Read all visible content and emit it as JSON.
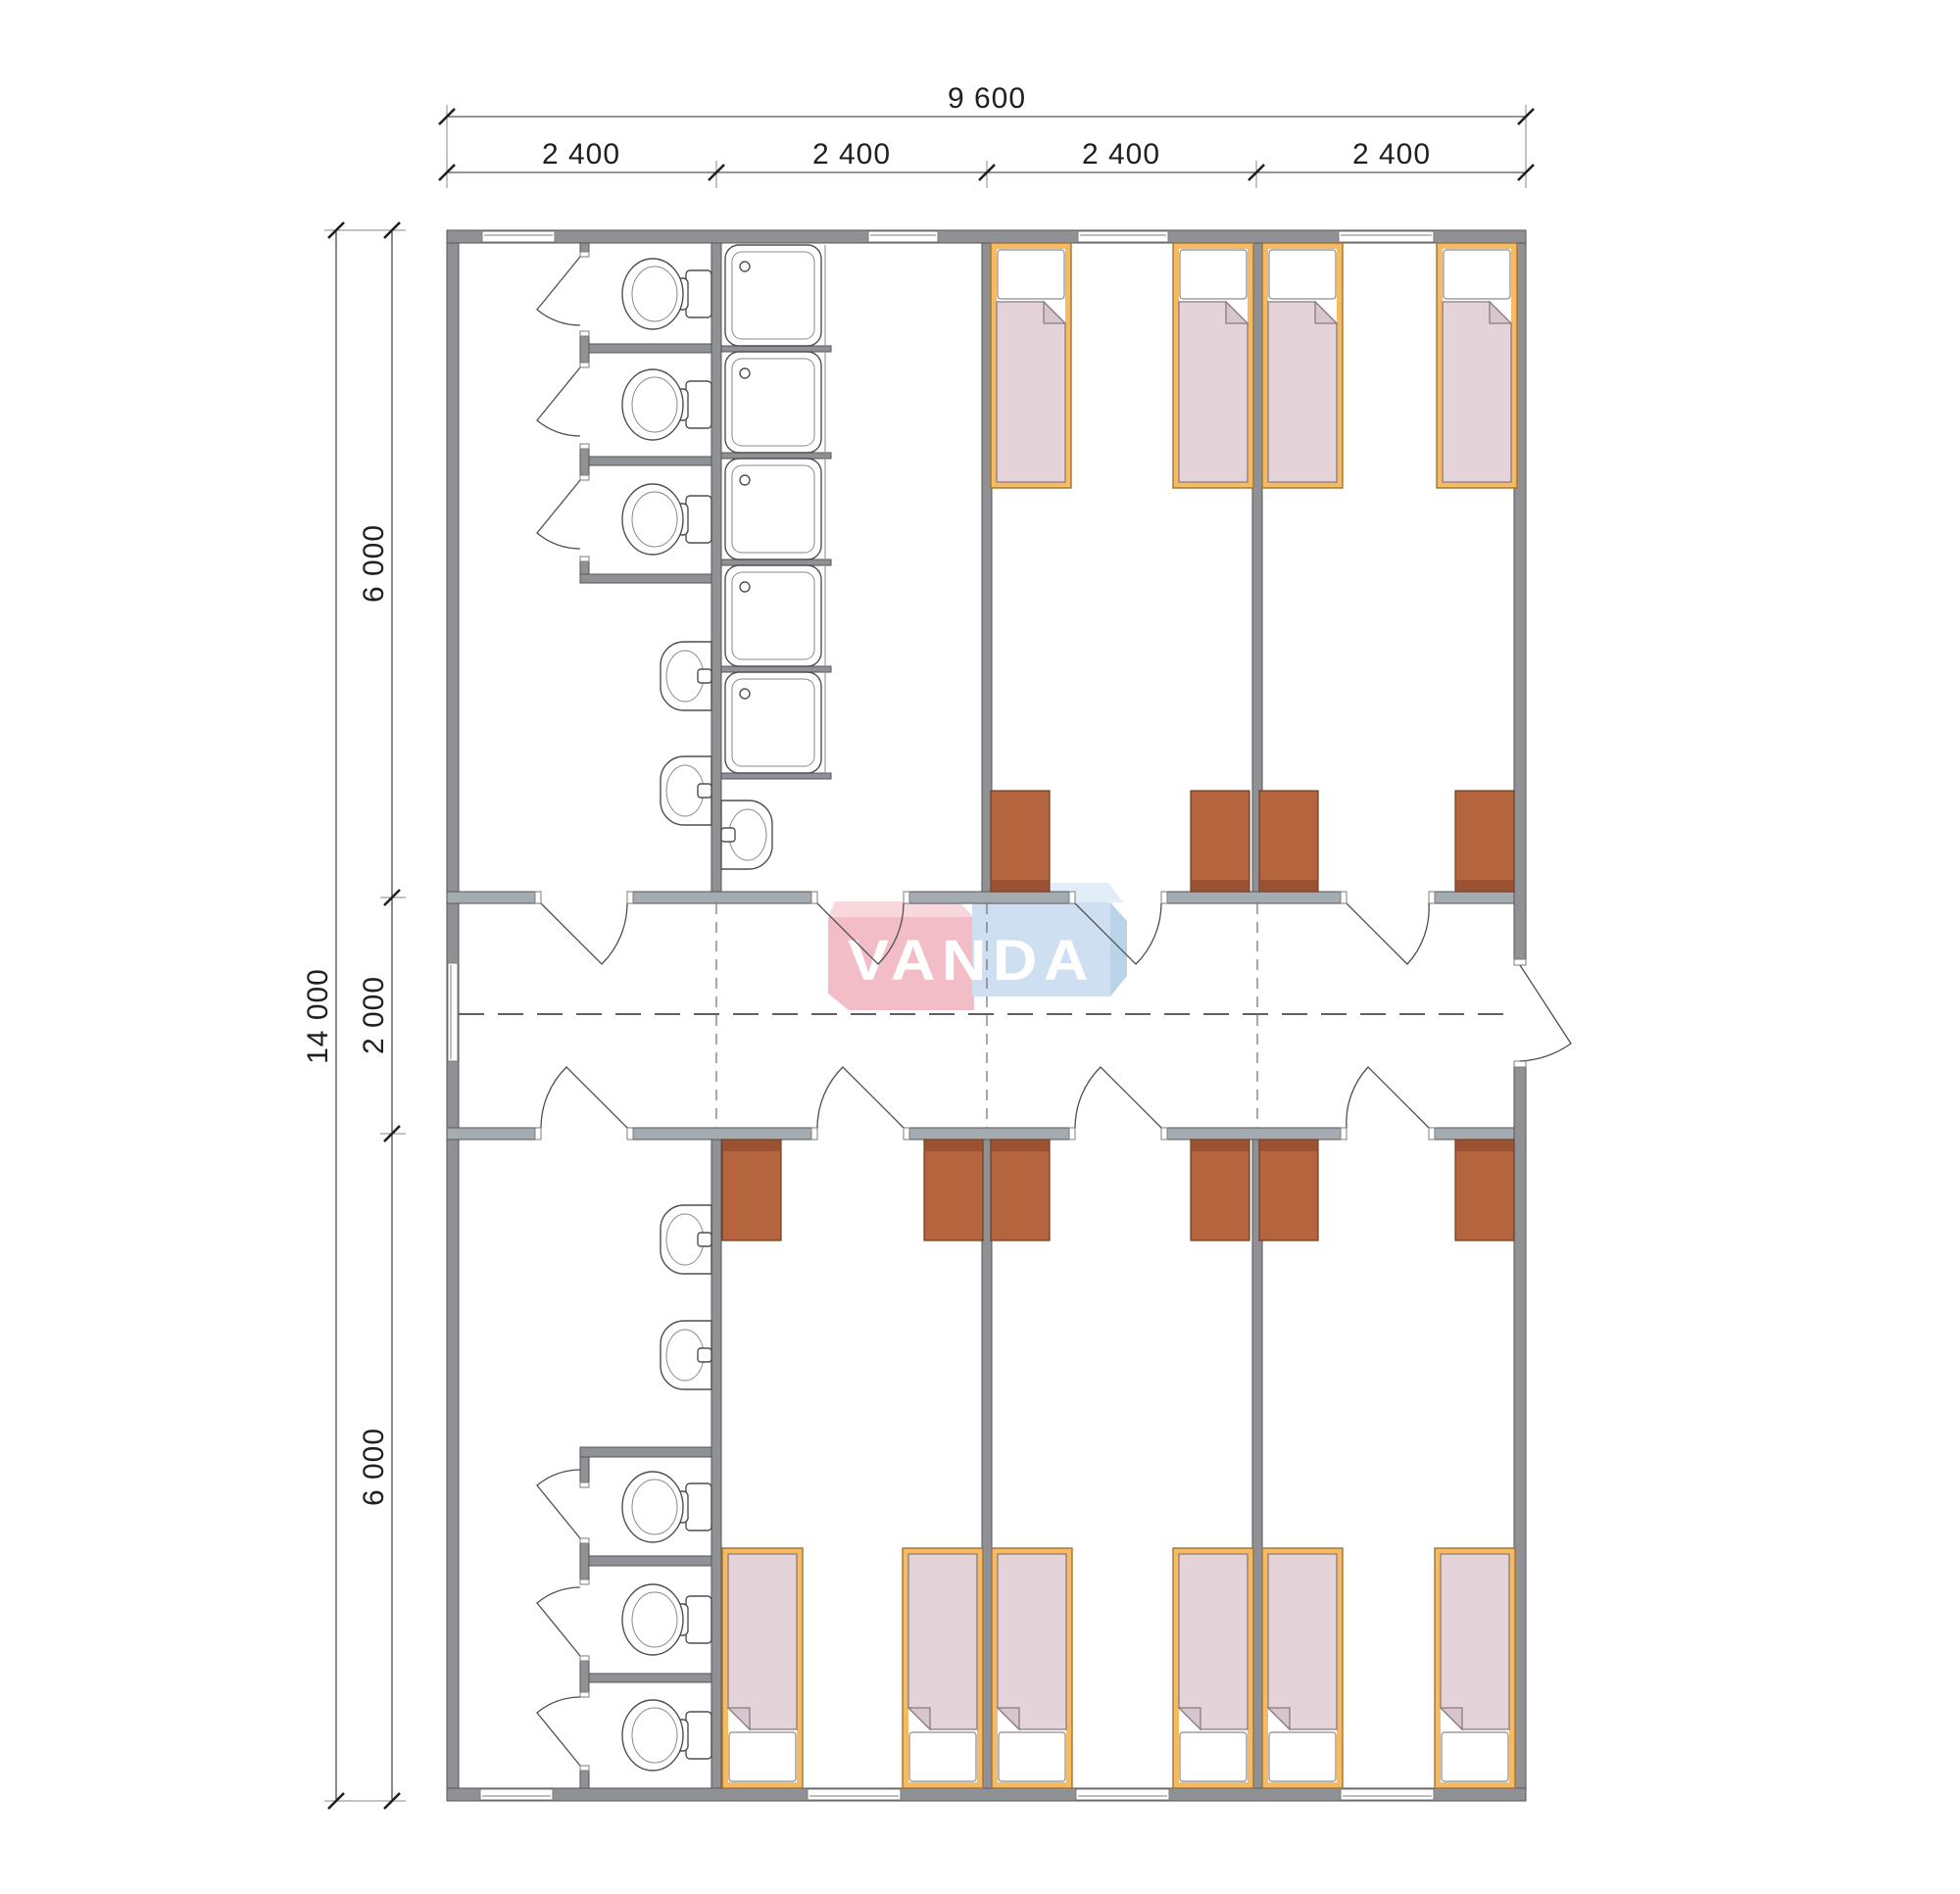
{
  "dimensions": {
    "top_total": "9 600",
    "top_modules": [
      "2 400",
      "2 400",
      "2 400",
      "2 400"
    ],
    "left_total": "14 000",
    "left_segments": [
      "6 000",
      "2 000",
      "6 000"
    ]
  },
  "logo": {
    "text": "VANDA",
    "pink_main": "#f3bdc8",
    "pink_top": "#f8d7dd",
    "blue_main": "#cddff1",
    "blue_top": "#e1eefa",
    "blue_side": "#b9d3e9"
  },
  "colors": {
    "wall": "#8f9194",
    "corridor_wall": "#a4acb2",
    "bed_frame": "#f5ba62",
    "blanket": "#e5d3da",
    "blanket_fold": "#d9c5ce",
    "wardrobe": "#b5653e",
    "wardrobe_dark": "#9a5232"
  },
  "plan_summary": {
    "beds": 10,
    "toilets": 6,
    "showers": 5,
    "sinks": 5,
    "wardrobes": 10
  }
}
